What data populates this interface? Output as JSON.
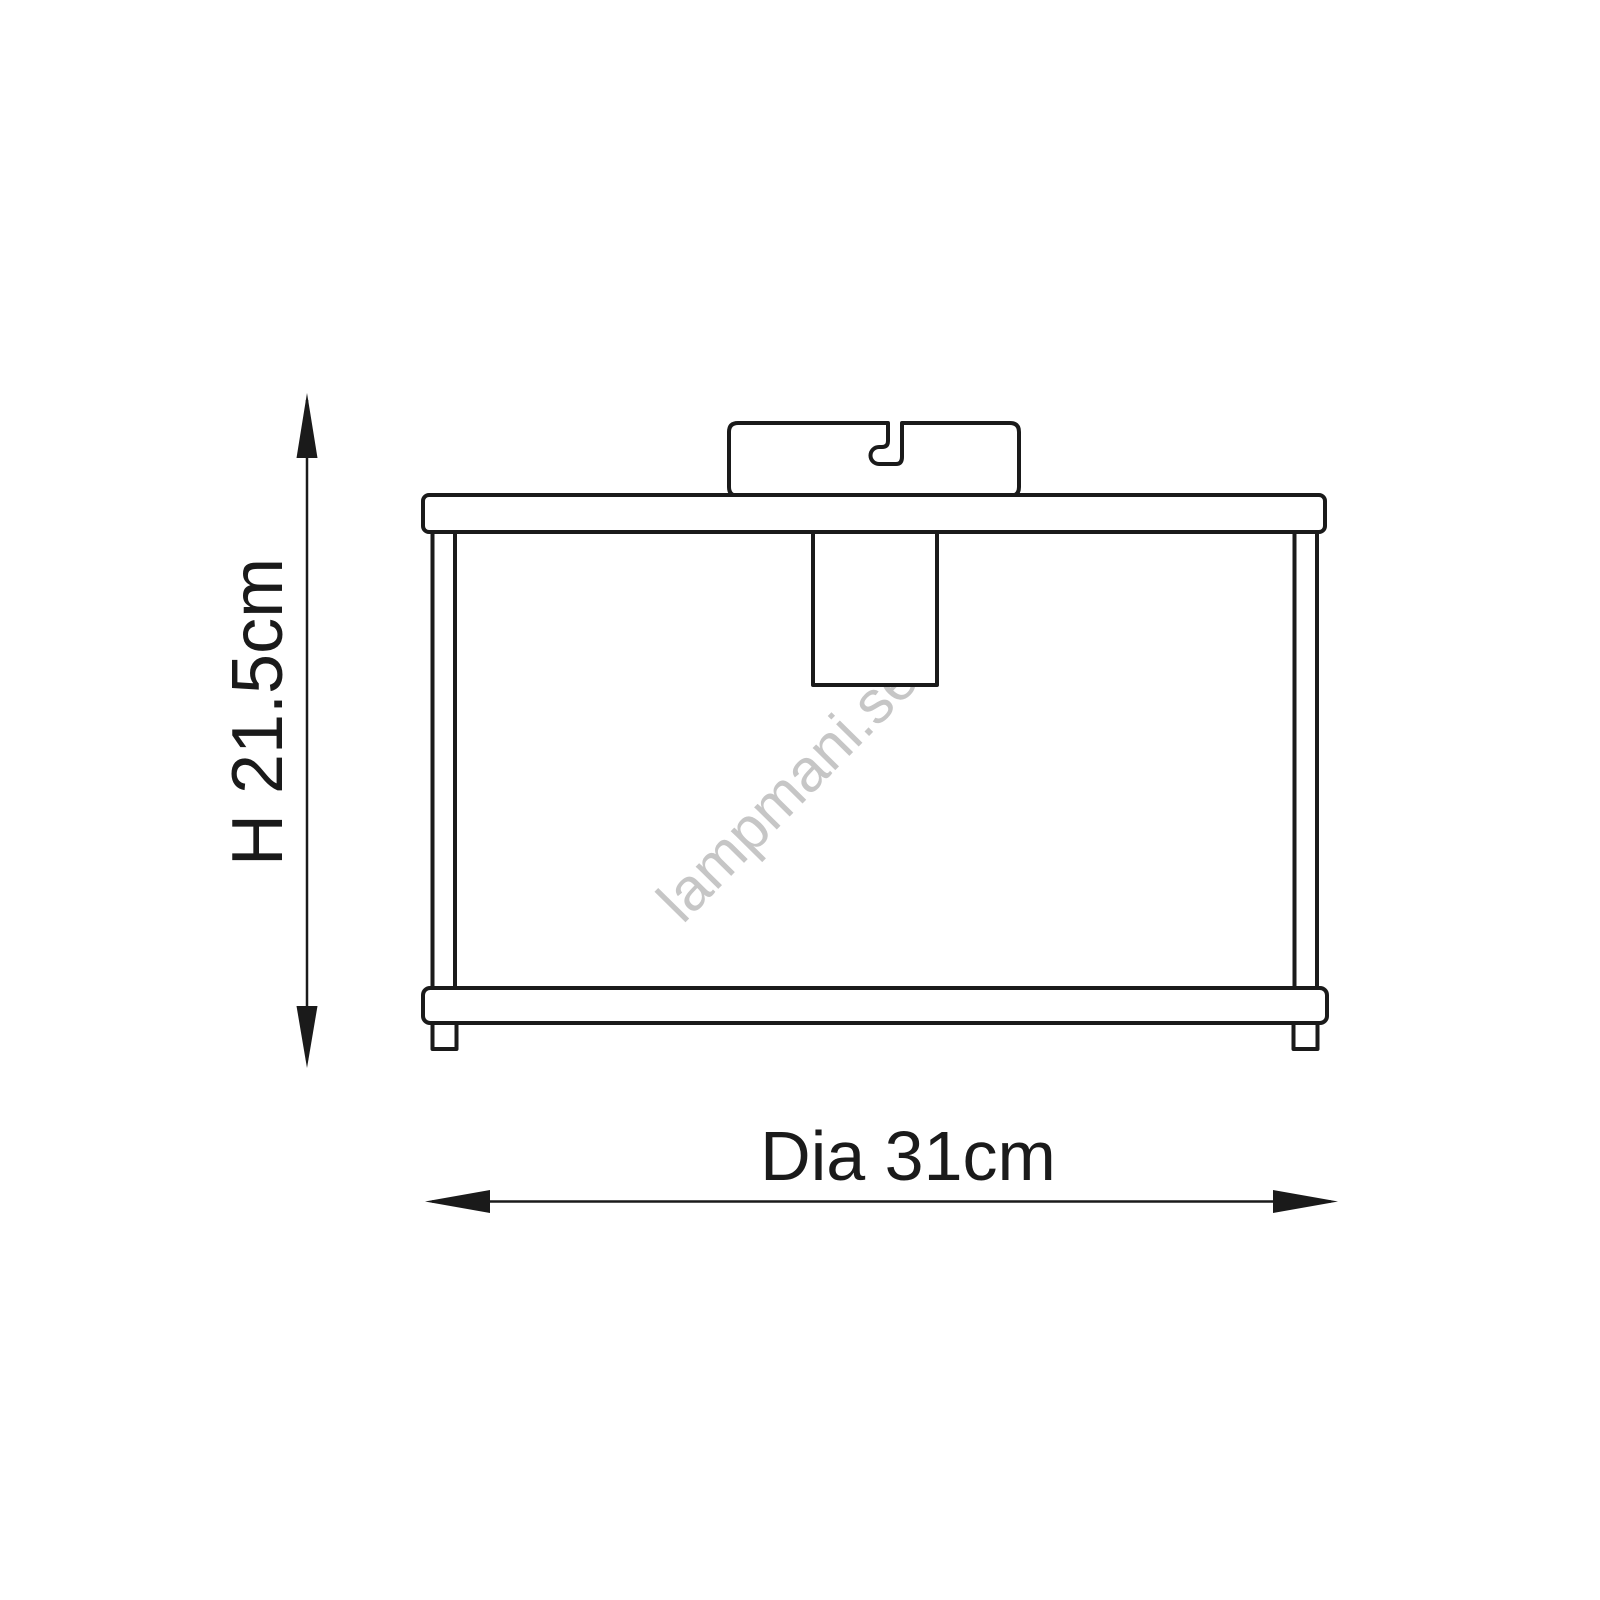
{
  "page": {
    "background_color": "#ffffff",
    "line_color": "#1a1a1a"
  },
  "diagram": {
    "watermark": {
      "text": "lampmani.se",
      "color": "#c6c6c6"
    },
    "dimensions": {
      "height": {
        "label": "H 21.5cm",
        "value_cm": 21.5,
        "axis": "vertical"
      },
      "diameter": {
        "label": "Dia 31cm",
        "value_cm": 31,
        "axis": "horizontal"
      }
    }
  }
}
